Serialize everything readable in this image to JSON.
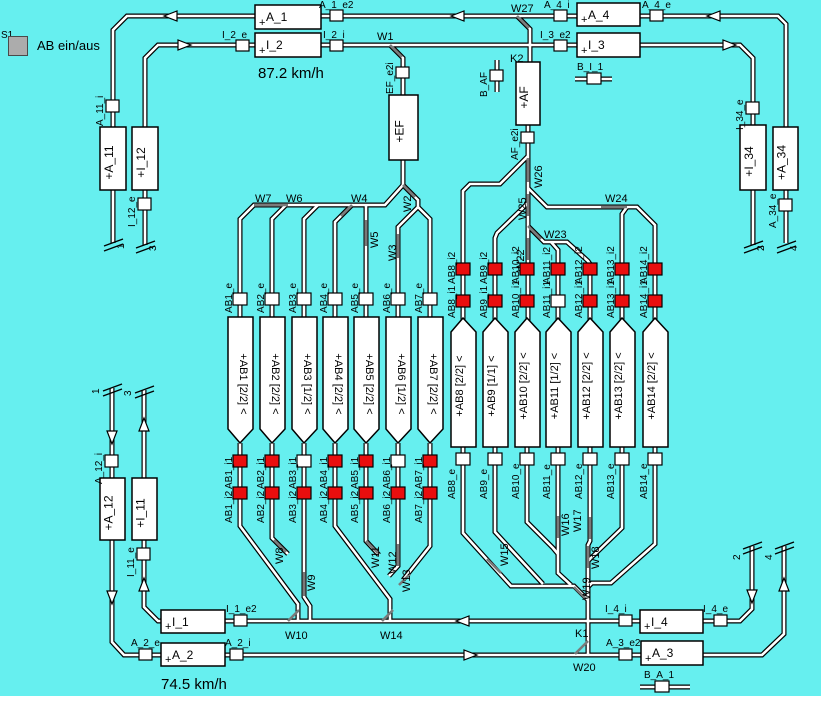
{
  "panel": {
    "s_label": "S1",
    "button_label": "AB ein/aus"
  },
  "speeds": {
    "upper": "87.2 km/h",
    "lower": "74.5 km/h"
  },
  "colors": {
    "background": "#66EFEF",
    "track_white": "#FFFFFF",
    "track_black": "#000000",
    "switch_gray": "#7A7A7A",
    "occupied": "#E90E0E",
    "free": "#FFFFFF",
    "button_gray": "#ACACAC",
    "block_fill": "#FFFFFF"
  },
  "blocks": [
    {
      "name": "A_1",
      "x": 255,
      "y": 5,
      "w": 66,
      "h": 24,
      "o": "h"
    },
    {
      "name": "I_2",
      "x": 255,
      "y": 33,
      "w": 66,
      "h": 24,
      "o": "h"
    },
    {
      "name": "A_4",
      "x": 577,
      "y": 3,
      "w": 63,
      "h": 23,
      "o": "h"
    },
    {
      "name": "I_3",
      "x": 577,
      "y": 33,
      "w": 63,
      "h": 24,
      "o": "h"
    },
    {
      "name": "I_1",
      "x": 161,
      "y": 610,
      "w": 64,
      "h": 23,
      "o": "h"
    },
    {
      "name": "A_2",
      "x": 161,
      "y": 643,
      "w": 64,
      "h": 23,
      "o": "h"
    },
    {
      "name": "I_4",
      "x": 640,
      "y": 610,
      "w": 63,
      "h": 23,
      "o": "h"
    },
    {
      "name": "A_3",
      "x": 641,
      "y": 641,
      "w": 62,
      "h": 24,
      "o": "h"
    },
    {
      "name": "A_11",
      "x": 100,
      "y": 127,
      "w": 26,
      "h": 63,
      "o": "v"
    },
    {
      "name": "I_12",
      "x": 132,
      "y": 127,
      "w": 26,
      "h": 63,
      "o": "v"
    },
    {
      "name": "I_34",
      "x": 740,
      "y": 125,
      "w": 26,
      "h": 65,
      "o": "v"
    },
    {
      "name": "A_34",
      "x": 773,
      "y": 127,
      "w": 25,
      "h": 63,
      "o": "v"
    },
    {
      "name": "A_12",
      "x": 100,
      "y": 478,
      "w": 25,
      "h": 62,
      "o": "v"
    },
    {
      "name": "I_11",
      "x": 132,
      "y": 478,
      "w": 25,
      "h": 62,
      "o": "v"
    },
    {
      "name": "EF",
      "x": 389,
      "y": 95,
      "w": 29,
      "h": 65,
      "o": "v"
    },
    {
      "name": "AF",
      "x": 516,
      "y": 62,
      "w": 24,
      "h": 63,
      "o": "v"
    }
  ],
  "sensors": [
    {
      "name": "A_1_e2",
      "bx": 330,
      "by": 10,
      "bw": 13,
      "bh": 11,
      "lx": 319,
      "ly": 8,
      "rot": 0
    },
    {
      "name": "I_2_e",
      "bx": 236,
      "by": 40,
      "bw": 13,
      "bh": 11,
      "lx": 222,
      "ly": 38,
      "rot": 0
    },
    {
      "name": "I_2_i",
      "bx": 330,
      "by": 40,
      "bw": 13,
      "bh": 11,
      "lx": 323,
      "ly": 38,
      "rot": 0
    },
    {
      "name": "A_4_i",
      "bx": 554,
      "by": 10,
      "bw": 13,
      "bh": 11,
      "lx": 544,
      "ly": 8,
      "rot": 0
    },
    {
      "name": "A_4_e",
      "bx": 650,
      "by": 10,
      "bw": 13,
      "bh": 11,
      "lx": 642,
      "ly": 8,
      "rot": 0
    },
    {
      "name": "I_3_e2",
      "bx": 554,
      "by": 40,
      "bw": 13,
      "bh": 11,
      "lx": 540,
      "ly": 38,
      "rot": 0
    },
    {
      "name": "B_I_1",
      "bx": 587,
      "by": 73,
      "bw": 14,
      "bh": 11,
      "lx": 577,
      "ly": 70,
      "rot": 0
    },
    {
      "name": "I_1_e2",
      "bx": 234,
      "by": 615,
      "bw": 13,
      "bh": 11,
      "lx": 226,
      "ly": 612,
      "rot": 0
    },
    {
      "name": "I_4_i",
      "bx": 619,
      "by": 615,
      "bw": 13,
      "bh": 11,
      "lx": 605,
      "ly": 612,
      "rot": 0
    },
    {
      "name": "I_4_e",
      "bx": 714,
      "by": 615,
      "bw": 13,
      "bh": 11,
      "lx": 703,
      "ly": 612,
      "rot": 0
    },
    {
      "name": "A_2_e",
      "bx": 139,
      "by": 649,
      "bw": 13,
      "bh": 11,
      "lx": 131,
      "ly": 646,
      "rot": 0
    },
    {
      "name": "A_2_i",
      "bx": 230,
      "by": 649,
      "bw": 13,
      "bh": 11,
      "lx": 225,
      "ly": 646,
      "rot": 0
    },
    {
      "name": "A_3_e2",
      "bx": 619,
      "by": 649,
      "bw": 13,
      "bh": 11,
      "lx": 606,
      "ly": 646,
      "rot": 0
    },
    {
      "name": "B_A_1",
      "bx": 655,
      "by": 681,
      "bw": 14,
      "bh": 11,
      "lx": 644,
      "ly": 678,
      "rot": 0
    },
    {
      "name": "A_11_i",
      "bx": 106,
      "by": 100,
      "bw": 13,
      "bh": 12,
      "lx": 103,
      "ly": 126,
      "rot": -90
    },
    {
      "name": "I_12_e",
      "bx": 138,
      "by": 198,
      "bw": 13,
      "bh": 12,
      "lx": 135,
      "ly": 227,
      "rot": -90
    },
    {
      "name": "I_34_e",
      "bx": 746,
      "by": 102,
      "bw": 13,
      "bh": 12,
      "lx": 743,
      "ly": 130,
      "rot": -90
    },
    {
      "name": "A_34_e",
      "bx": 779,
      "by": 199,
      "bw": 13,
      "bh": 12,
      "lx": 776,
      "ly": 228,
      "rot": -90
    },
    {
      "name": "A_12_i",
      "bx": 105,
      "by": 455,
      "bw": 13,
      "bh": 12,
      "lx": 102,
      "ly": 484,
      "rot": -90
    },
    {
      "name": "I_11_e",
      "bx": 137,
      "by": 548,
      "bw": 13,
      "bh": 12,
      "lx": 134,
      "ly": 577,
      "rot": -90
    },
    {
      "name": "EF_e2i",
      "bx": 396,
      "by": 67,
      "bw": 13,
      "bh": 11,
      "lx": 393,
      "ly": 94,
      "rot": -90
    },
    {
      "name": "AF_e2i",
      "bx": 521,
      "by": 132,
      "bw": 13,
      "bh": 11,
      "lx": 518,
      "ly": 160,
      "rot": -90
    },
    {
      "name": "B_AF",
      "bx": 490,
      "by": 70,
      "bw": 13,
      "bh": 11,
      "lx": 487,
      "ly": 97,
      "rot": -90
    }
  ],
  "switches": [
    {
      "name": "W1",
      "lx": 377,
      "ly": 40,
      "rot": 0,
      "seg": [
        [
          390,
          45
        ],
        [
          402,
          57
        ]
      ]
    },
    {
      "name": "W2",
      "lx": 411,
      "ly": 212,
      "rot": -90,
      "seg": [
        [
          403,
          185
        ],
        [
          415,
          197
        ]
      ]
    },
    {
      "name": "W3",
      "lx": 396,
      "ly": 261,
      "rot": -90,
      "seg": [
        [
          398,
          234
        ],
        [
          398,
          258
        ]
      ]
    },
    {
      "name": "W4",
      "lx": 351,
      "ly": 202,
      "rot": 0,
      "seg": [
        [
          352,
          205
        ],
        [
          341,
          216
        ]
      ]
    },
    {
      "name": "W5",
      "lx": 378,
      "ly": 248,
      "rot": -90,
      "seg": [
        [
          366,
          220
        ],
        [
          366,
          246
        ]
      ]
    },
    {
      "name": "W6",
      "lx": 286,
      "ly": 202,
      "rot": 0,
      "seg": [
        [
          271,
          205
        ],
        [
          288,
          205
        ]
      ]
    },
    {
      "name": "W7",
      "lx": 255,
      "ly": 202,
      "rot": 0,
      "seg": [
        [
          254,
          205
        ],
        [
          271,
          205
        ]
      ]
    },
    {
      "name": "W8",
      "lx": 283,
      "ly": 564,
      "rot": -90,
      "seg": [
        [
          274,
          540
        ],
        [
          286,
          552
        ]
      ]
    },
    {
      "name": "W9",
      "lx": 315,
      "ly": 591,
      "rot": -90,
      "seg": [
        [
          304,
          572
        ],
        [
          304,
          596
        ]
      ]
    },
    {
      "name": "W10",
      "lx": 285,
      "ly": 639,
      "rot": 0,
      "seg": [
        [
          288,
          621
        ],
        [
          299,
          610
        ]
      ]
    },
    {
      "name": "W11",
      "lx": 379,
      "ly": 568,
      "rot": -90,
      "seg": [
        [
          366,
          541
        ],
        [
          378,
          553
        ]
      ]
    },
    {
      "name": "W12",
      "lx": 396,
      "ly": 574,
      "rot": -90,
      "seg": [
        [
          398,
          544
        ],
        [
          398,
          566
        ]
      ]
    },
    {
      "name": "W13",
      "lx": 410,
      "ly": 592,
      "rot": -90,
      "seg": [
        [
          410,
          574
        ],
        [
          399,
          585
        ]
      ]
    },
    {
      "name": "W14",
      "lx": 380,
      "ly": 639,
      "rot": 0,
      "seg": [
        [
          382,
          621
        ],
        [
          393,
          610
        ]
      ]
    },
    {
      "name": "W15",
      "lx": 508,
      "ly": 566,
      "rot": -90,
      "seg": [
        [
          487,
          559
        ],
        [
          501,
          573
        ]
      ]
    },
    {
      "name": "W16",
      "lx": 569,
      "ly": 536,
      "rot": -90,
      "seg": [
        [
          558,
          516
        ],
        [
          558,
          538
        ]
      ]
    },
    {
      "name": "W17",
      "lx": 581,
      "ly": 532,
      "rot": -90,
      "seg": [
        [
          590,
          517
        ],
        [
          590,
          539
        ]
      ]
    },
    {
      "name": "W18",
      "lx": 599,
      "ly": 569,
      "rot": -90,
      "seg": [
        [
          588,
          546
        ],
        [
          588,
          568
        ]
      ]
    },
    {
      "name": "W19",
      "lx": 590,
      "ly": 600,
      "rot": -90,
      "seg": [
        [
          574,
          587
        ],
        [
          586,
          599
        ]
      ]
    },
    {
      "name": "W20",
      "lx": 573,
      "ly": 671,
      "rot": 0,
      "seg": [
        [
          588,
          641
        ],
        [
          575,
          654
        ]
      ]
    },
    {
      "name": "W22",
      "lx": 524,
      "ly": 272,
      "rot": -90,
      "seg": [
        [
          528,
          238
        ],
        [
          528,
          260
        ]
      ]
    },
    {
      "name": "W23",
      "lx": 544,
      "ly": 238,
      "rot": 0,
      "seg": [
        [
          528,
          226
        ],
        [
          541,
          239
        ]
      ]
    },
    {
      "name": "W24",
      "lx": 605,
      "ly": 202,
      "rot": 0,
      "seg": [
        [
          601,
          207
        ],
        [
          627,
          207
        ]
      ]
    },
    {
      "name": "W25",
      "lx": 526,
      "ly": 220,
      "rot": -90,
      "seg": [
        [
          528,
          194
        ],
        [
          528,
          216
        ]
      ]
    },
    {
      "name": "W26",
      "lx": 542,
      "ly": 188,
      "rot": -90,
      "seg": [
        [
          528,
          158
        ],
        [
          528,
          182
        ]
      ]
    },
    {
      "name": "W27",
      "lx": 511,
      "ly": 12,
      "rot": 0,
      "seg": [
        [
          517,
          16
        ],
        [
          529,
          28
        ]
      ]
    }
  ],
  "crossings": [
    {
      "name": "K2",
      "x": 510,
      "y": 62
    },
    {
      "name": "K1",
      "x": 575,
      "y": 637
    }
  ],
  "arrows": [
    {
      "x": 171,
      "y": 16,
      "dir": "left"
    },
    {
      "x": 458,
      "y": 16,
      "dir": "left"
    },
    {
      "x": 714,
      "y": 16,
      "dir": "left"
    },
    {
      "x": 184,
      "y": 45,
      "dir": "right"
    },
    {
      "x": 729,
      "y": 45,
      "dir": "right"
    },
    {
      "x": 112,
      "y": 437,
      "dir": "down"
    },
    {
      "x": 112,
      "y": 597,
      "dir": "down"
    },
    {
      "x": 144,
      "y": 425,
      "dir": "up"
    },
    {
      "x": 144,
      "y": 585,
      "dir": "up"
    },
    {
      "x": 463,
      "y": 621,
      "dir": "left"
    },
    {
      "x": 470,
      "y": 655,
      "dir": "right"
    },
    {
      "x": 752,
      "y": 596,
      "dir": "down"
    },
    {
      "x": 784,
      "y": 585,
      "dir": "up"
    }
  ],
  "track_ends": [
    {
      "x": 113,
      "y": 243,
      "label": "1",
      "lx": 124,
      "ly": 249
    },
    {
      "x": 145,
      "y": 245,
      "label": "3",
      "lx": 156,
      "ly": 251
    },
    {
      "x": 753,
      "y": 245,
      "label": "2",
      "lx": 764,
      "ly": 251
    },
    {
      "x": 786,
      "y": 245,
      "label": "4",
      "lx": 797,
      "ly": 251
    },
    {
      "x": 112,
      "y": 388,
      "label": "1",
      "lx": 99,
      "ly": 394
    },
    {
      "x": 144,
      "y": 390,
      "label": "3",
      "lx": 131,
      "ly": 396
    },
    {
      "x": 752,
      "y": 546,
      "label": "2",
      "lx": 740,
      "ly": 560
    },
    {
      "x": 784,
      "y": 546,
      "label": "4",
      "lx": 772,
      "ly": 560
    }
  ],
  "ab_groups": {
    "left": {
      "cx": [
        240,
        272,
        304,
        335,
        366,
        398,
        430
      ],
      "items": [
        {
          "name": "AB1",
          "cap": "[2/2]",
          "i1": true,
          "i2": true
        },
        {
          "name": "AB2",
          "cap": "[2/2]",
          "i1": true,
          "i2": true
        },
        {
          "name": "AB3",
          "cap": "[1/2]",
          "i1": false,
          "i2": true
        },
        {
          "name": "AB4",
          "cap": "[2/2]",
          "i1": true,
          "i2": true
        },
        {
          "name": "AB5",
          "cap": "[2/2]",
          "i1": true,
          "i2": true
        },
        {
          "name": "AB6",
          "cap": "[1/2]",
          "i1": false,
          "i2": true
        },
        {
          "name": "AB7",
          "cap": "[2/2]",
          "i1": true,
          "i2": true
        }
      ]
    },
    "right": {
      "cx": [
        463,
        495,
        527,
        558,
        590,
        622,
        655
      ],
      "items": [
        {
          "name": "AB8",
          "cap": "[2/2]",
          "i1": true,
          "i2": true
        },
        {
          "name": "AB9",
          "cap": "[1/1]",
          "i1": true,
          "i2": true
        },
        {
          "name": "AB10",
          "cap": "[2/2]",
          "i1": true,
          "i2": true
        },
        {
          "name": "AB11",
          "cap": "[1/2]",
          "i1": false,
          "i2": true
        },
        {
          "name": "AB12",
          "cap": "[2/2]",
          "i1": true,
          "i2": true
        },
        {
          "name": "AB13",
          "cap": "[2/2]",
          "i1": true,
          "i2": true
        },
        {
          "name": "AB14",
          "cap": "[2/2]",
          "i1": true,
          "i2": true
        }
      ]
    }
  }
}
